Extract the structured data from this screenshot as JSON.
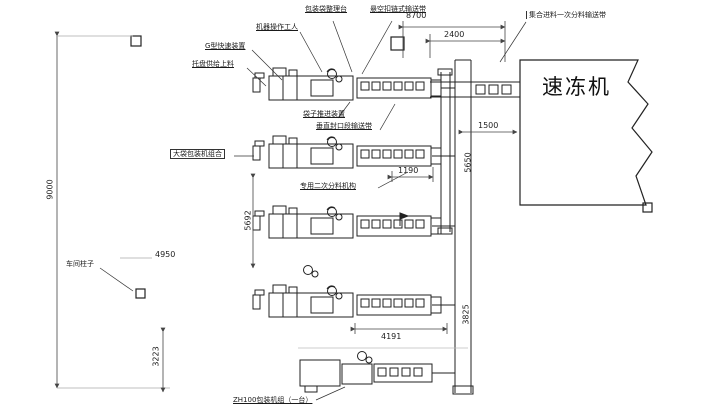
{
  "drawing": {
    "title_hint": "packaging-line floor plan feeding a quick freezer",
    "labels": {
      "top_label_1": "包装袋整理台",
      "top_label_2": "悬空扣链式输送带",
      "operator_label": "机器操作工人",
      "device_label_1": "G型快速装置",
      "device_label_2": "托盘供给上料",
      "feeder_label_1": "袋子推进装置",
      "feeder_label_2": "垂直封口段输送带",
      "machine_group_label": "大袋包装机组合",
      "secondary_feeder_label": "专用二次分料机构",
      "distribution_label": "集合进料一次分料输送带",
      "freezer_label": "速冻机",
      "pillar_label": "车间柱子",
      "bottom_label": "ZH100包装机组（一台）"
    },
    "dimensions": {
      "d8700": "8700",
      "d2400": "2400",
      "d9000": "9000",
      "d1500": "1500",
      "d5650": "5650",
      "d3825": "3825",
      "d1190": "1190",
      "d4950": "4950",
      "d5692": "5692",
      "d4191": "4191",
      "d3223": "3223"
    },
    "colors": {
      "line": "#222222",
      "dim_line": "#444444",
      "light_line": "#aaaaaa",
      "background": "#ffffff"
    }
  }
}
